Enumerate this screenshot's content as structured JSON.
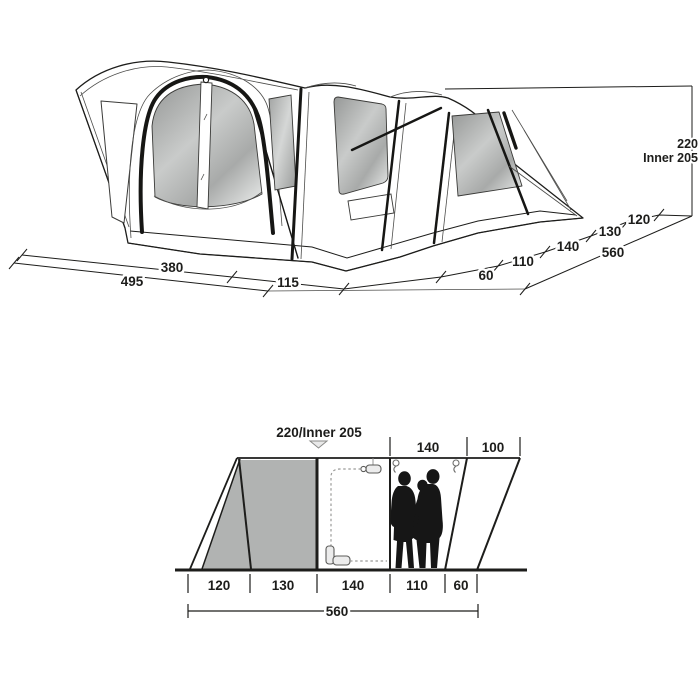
{
  "top_view": {
    "height_labels": [
      "220",
      "Inner 205"
    ],
    "front_dims": [
      "380",
      "495",
      "115"
    ],
    "side_dims": [
      "60",
      "110",
      "140",
      "130",
      "120"
    ],
    "side_total": "560"
  },
  "section_view": {
    "peak_label": "220/Inner 205",
    "top_dims": [
      "140",
      "100"
    ],
    "floor_dims": [
      "120",
      "130",
      "140",
      "110",
      "60"
    ],
    "floor_total": "560"
  },
  "colors": {
    "line": "#1d1d1b",
    "window_gray_flat": "#b1b3b2",
    "window_gradient_dark": "#969897",
    "window_gradient_light": "#dddfde",
    "silhouette": "#161616",
    "background": "#ffffff"
  },
  "icons": {
    "peak_arrow": "down-arrow-icon",
    "lamp": "hanging-lamp-icon",
    "power_plug": "power-plug-icon",
    "hangers": "hook-icon",
    "people": "family-silhouette-icon"
  }
}
